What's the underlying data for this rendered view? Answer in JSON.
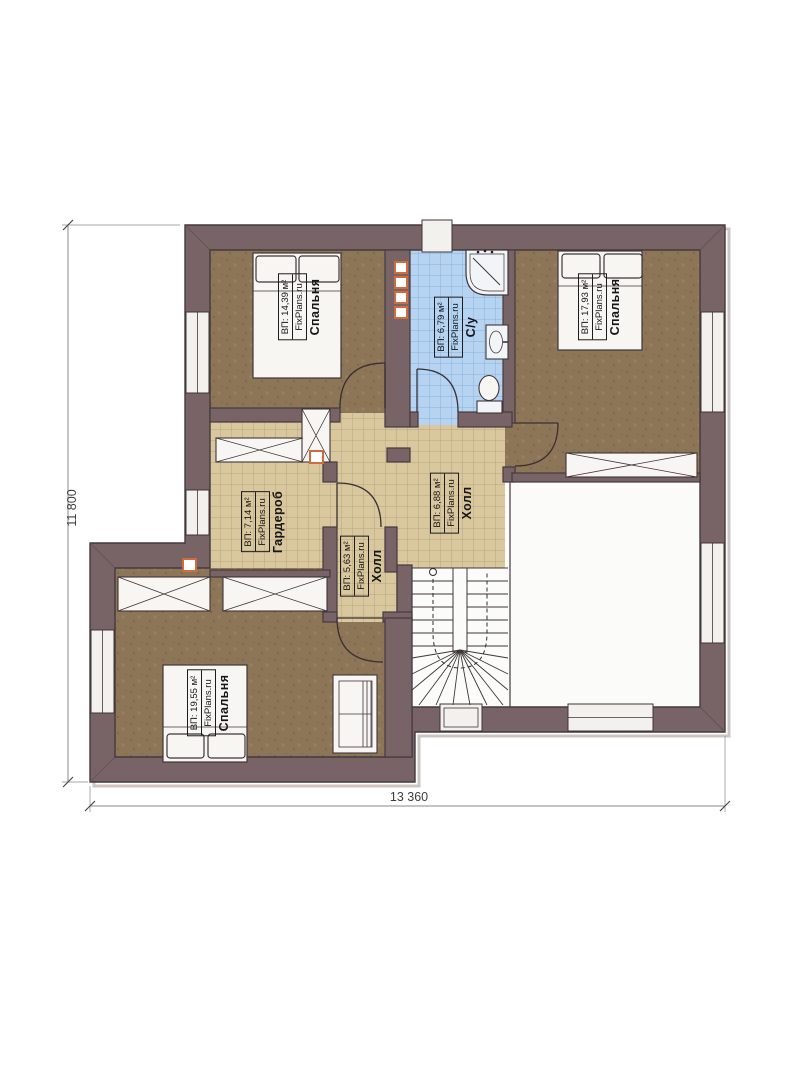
{
  "page": {
    "background": "#ffffff"
  },
  "plan": {
    "watermark": "FixPlans.ru",
    "dimensions": {
      "height_label": "11 800",
      "width_label": "13 360"
    },
    "rooms": [
      {
        "id": "bedroom-top-left",
        "name": "Спальня",
        "area": "ВП: 14,39 м²"
      },
      {
        "id": "bathroom",
        "name": "С/у",
        "area": "ВП: 6,79 м²"
      },
      {
        "id": "bedroom-top-right",
        "name": "Спальня",
        "area": "ВП: 17,93 м²"
      },
      {
        "id": "wardrobe",
        "name": "Гардероб",
        "area": "ВП: 7,14 м²"
      },
      {
        "id": "hall",
        "name": "Холл",
        "area": "ВП: 6,88 м²"
      },
      {
        "id": "hall-small",
        "name": "Холл",
        "area": "ВП: 5,63 м²"
      },
      {
        "id": "bedroom-bottom",
        "name": "Спальня",
        "area": "ВП: 19,55 м²"
      }
    ],
    "colors": {
      "wall": "#786366",
      "floor_wood": "#8d7557",
      "tile_beige": "#d9c79e",
      "tile_blue": "#b6d3f1",
      "accent_orange": "#cf6b3c"
    }
  }
}
